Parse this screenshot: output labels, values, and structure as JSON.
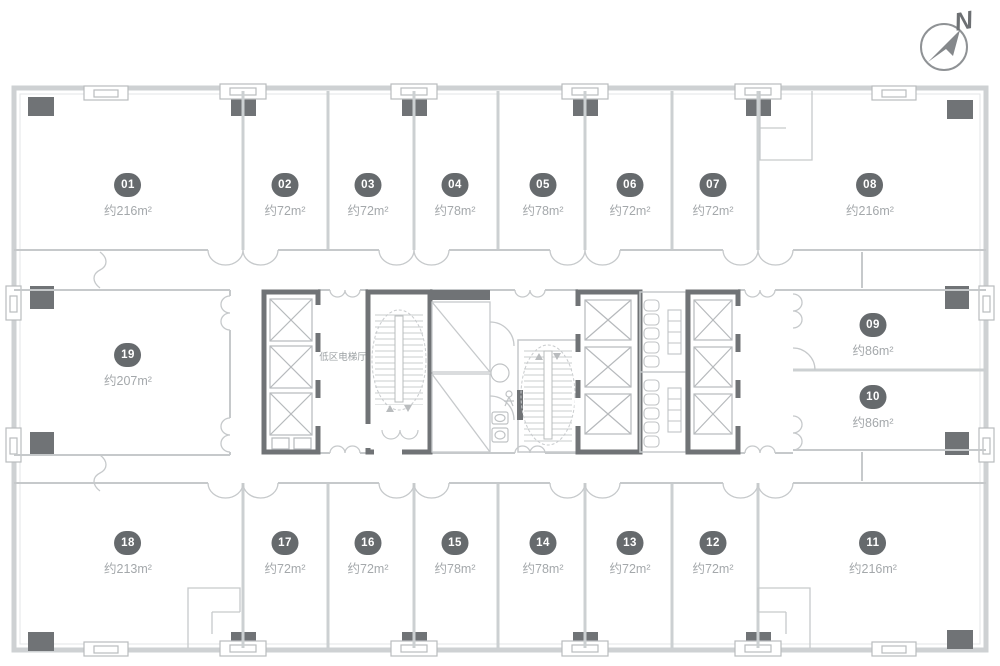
{
  "compass": {
    "label": "N"
  },
  "core": {
    "elevator_hall_label": "低区电梯厅"
  },
  "units": [
    {
      "id": "01",
      "area": "约216m²"
    },
    {
      "id": "02",
      "area": "约72m²"
    },
    {
      "id": "03",
      "area": "约72m²"
    },
    {
      "id": "04",
      "area": "约78m²"
    },
    {
      "id": "05",
      "area": "约78m²"
    },
    {
      "id": "06",
      "area": "约72m²"
    },
    {
      "id": "07",
      "area": "约72m²"
    },
    {
      "id": "08",
      "area": "约216m²"
    },
    {
      "id": "09",
      "area": "约86m²"
    },
    {
      "id": "10",
      "area": "约86m²"
    },
    {
      "id": "11",
      "area": "约216m²"
    },
    {
      "id": "12",
      "area": "约72m²"
    },
    {
      "id": "13",
      "area": "约72m²"
    },
    {
      "id": "14",
      "area": "约78m²"
    },
    {
      "id": "15",
      "area": "约78m²"
    },
    {
      "id": "16",
      "area": "约72m²"
    },
    {
      "id": "17",
      "area": "约72m²"
    },
    {
      "id": "18",
      "area": "约213m²"
    },
    {
      "id": "19",
      "area": "约207m²"
    }
  ]
}
